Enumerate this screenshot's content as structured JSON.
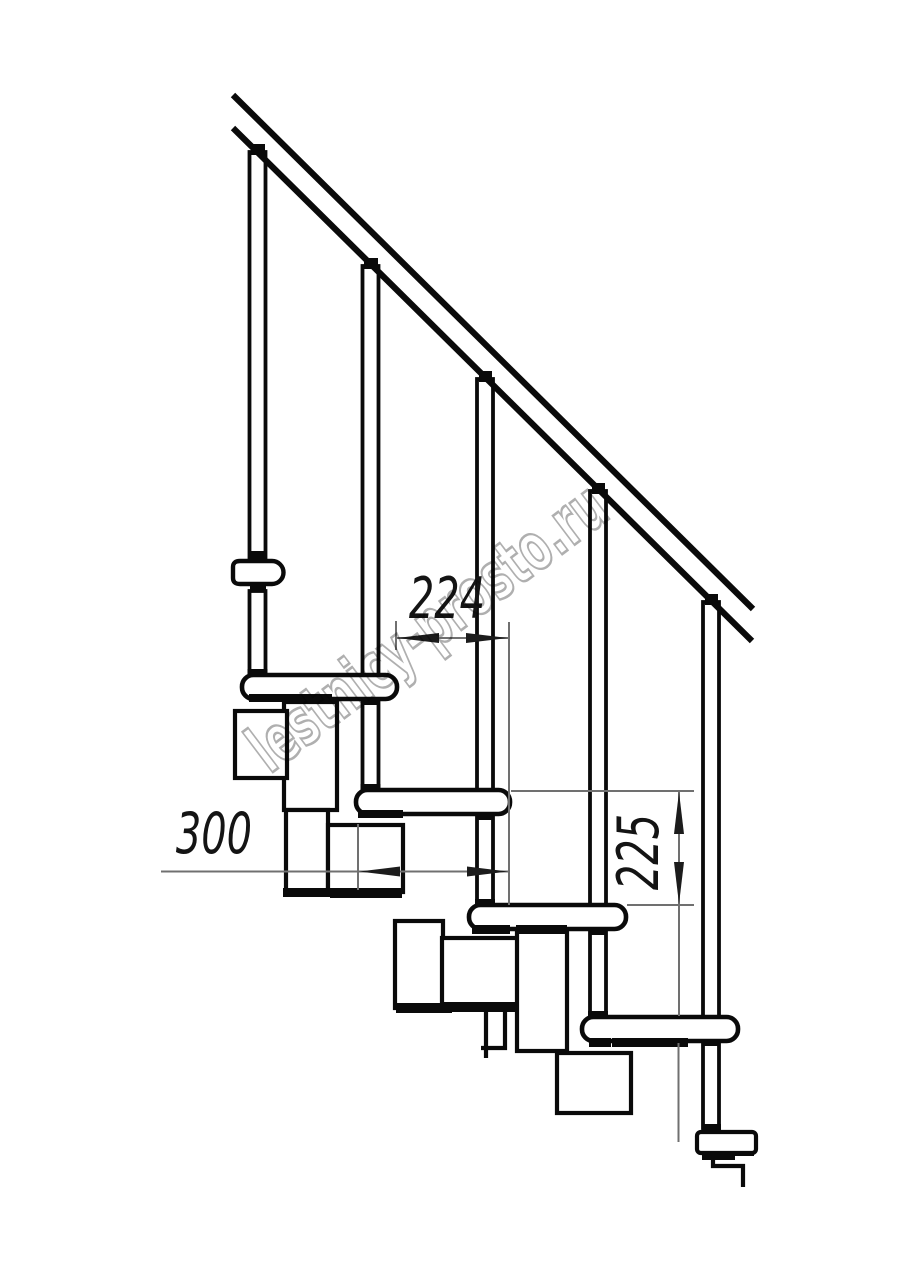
{
  "page": {
    "background": "#ffffff"
  },
  "drawing": {
    "type": "modular-staircase-side-elevation",
    "watermark": {
      "text": "lestnicy-prosto.ru",
      "color": "#a6a6a6"
    },
    "dimensions": [
      {
        "id": "step-run",
        "label": "224",
        "orientation": "horizontal"
      },
      {
        "id": "tread-length",
        "label": "300",
        "orientation": "horizontal"
      },
      {
        "id": "step-rise",
        "label": "225",
        "orientation": "vertical"
      }
    ],
    "colors": {
      "outline": "#0a0a0a",
      "fill": "#ffffff",
      "dimension_line": "#707070",
      "dimension_text": "#141414"
    }
  }
}
